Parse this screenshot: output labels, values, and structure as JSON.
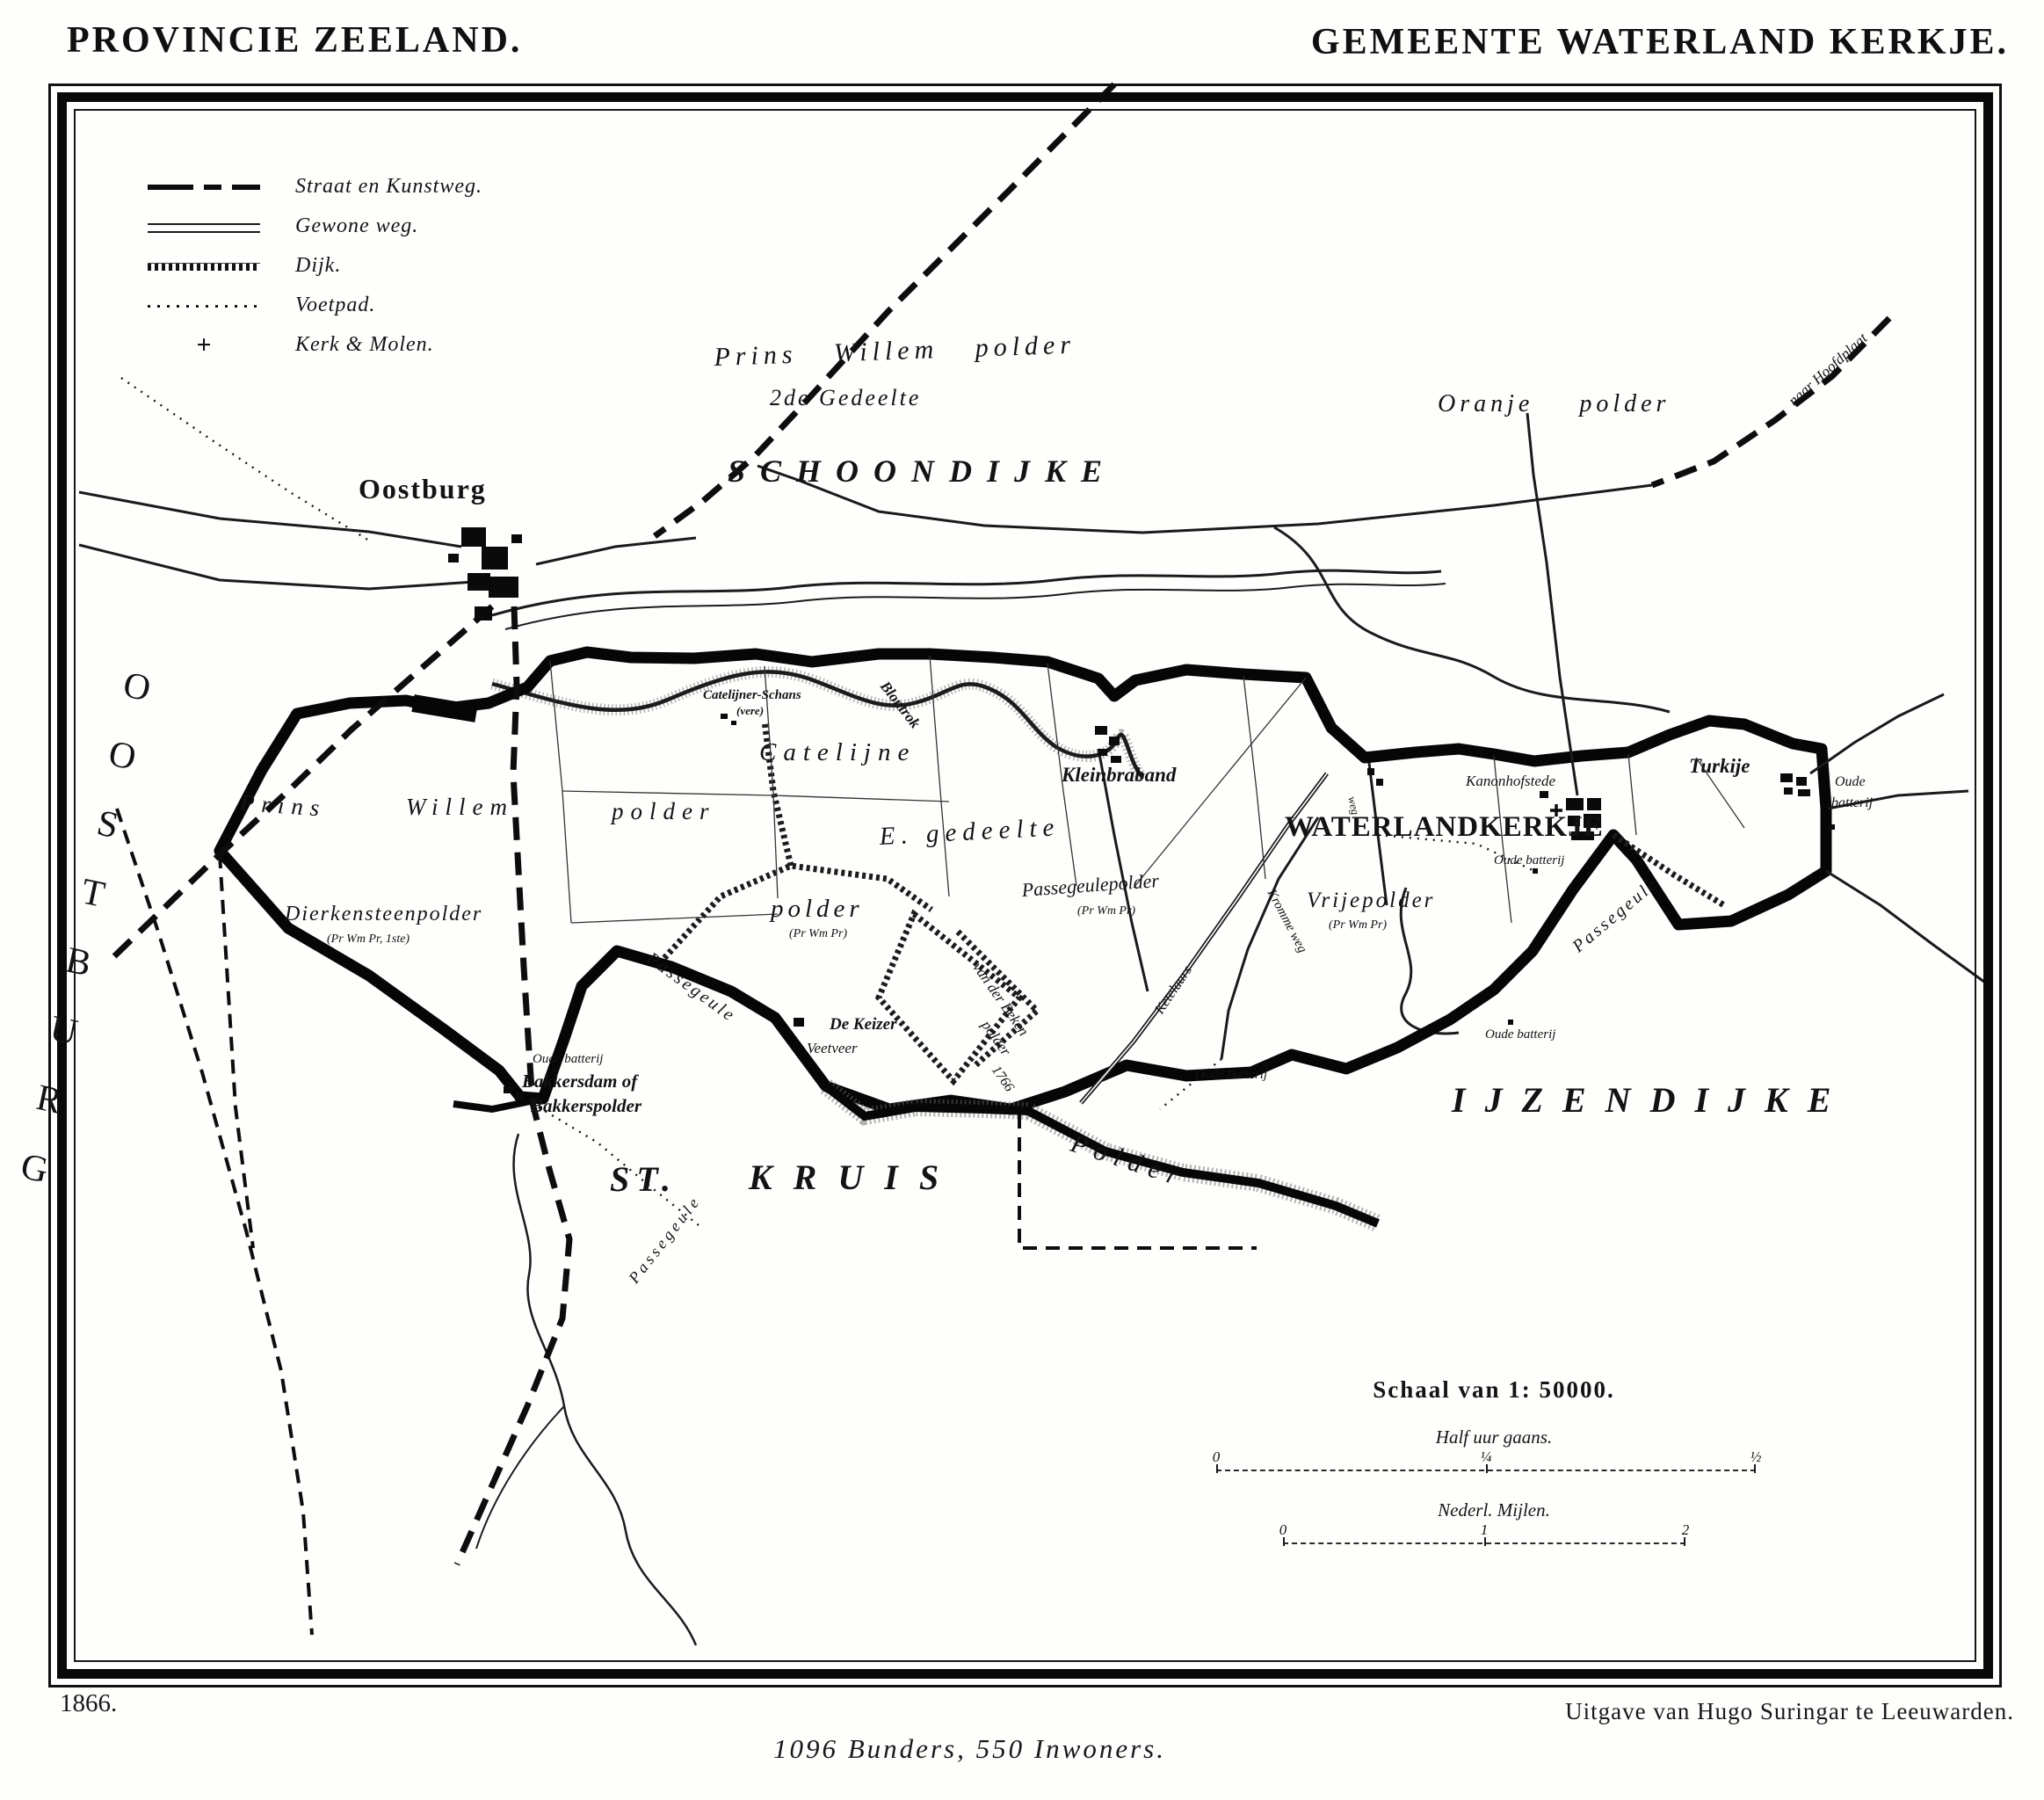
{
  "page": {
    "title_left": "PROVINCIE ZEELAND.",
    "title_right": "GEMEENTE WATERLAND KERKJE.",
    "year": "1866.",
    "publisher": "Uitgave van Hugo Suringar te Leeuwarden.",
    "stats": "1096 Bunders, 550 Inwoners."
  },
  "legend": {
    "items": [
      {
        "icon": "bold-dashed-line-icon",
        "label": "Straat en Kunstweg."
      },
      {
        "icon": "double-line-icon",
        "label": "Gewone weg."
      },
      {
        "icon": "hatched-line-icon",
        "label": "Dijk."
      },
      {
        "icon": "dotted-line-icon",
        "label": "Voetpad."
      },
      {
        "icon": "cross-windmill-icon",
        "label": "Kerk & Molen."
      }
    ],
    "kerk_glyph": "+"
  },
  "scale": {
    "title": "Schaal van 1: 50000.",
    "bar1_label": "Half uur gaans.",
    "bar1_ticks": [
      "0",
      "¼",
      "½"
    ],
    "bar2_label": "Nederl. Mijlen.",
    "bar2_ticks": [
      "0",
      "1",
      "2"
    ]
  },
  "labels": {
    "oostburg_region": "OOSTBURG",
    "oostburg_town": "Oostburg",
    "schoondijke": "SCHOONDIJKE",
    "prins_willem_polder": "Prins Willem polder",
    "tweede_gedeelte": "2de Gedeelte",
    "oranje_polder": "Oranje polder",
    "naar_hoofdplaat": "naar Hoofdplaat",
    "catelijner_schans": "Catelijner-Schans",
    "catelijner_schans_sub": "(vere)",
    "blontrok": "Blontrok",
    "catelijne": "Catelijne",
    "e_gedeelte": "E. gedeelte",
    "polder_word": "polder",
    "pr_wm_pr": "(Pr Wm Pr)",
    "kleinbraband": "Kleinbraband",
    "passegeulepolder": "Passegeulepolder",
    "waterlandkerkje": "WATERLANDKERKJE",
    "kanonhofstede": "Kanonhofstede",
    "oude_batterij": "Oude batterij",
    "oude_batterij_cap": "Oude Batterij",
    "oude_split_1": "Oude",
    "oude_split_2": "batterij",
    "turkije": "Turkije",
    "weg": "weg",
    "vrijepolder": "Vrijepolder",
    "ketelaars": "Ketelaars",
    "kromme_weg": "Kromme weg",
    "passegeule": "Passegeule",
    "ijzendijke": "IJZENDIJKE",
    "prins": "Prins",
    "willem": "Willem",
    "dierkensteenpolder": "Dierkensteenpolder",
    "dierkensteenpolder_sub": "(Pr Wm Pr, 1ste)",
    "de_keizer": "De Keizer",
    "veetveer": "Veetveer",
    "van_der_beken": "van der Beken",
    "beken_year": "1766",
    "bakkersdam": "Bakkersdam of",
    "bakkerspolder": "Bakkerspolder",
    "st": "ST.",
    "kruis": "KRUIS",
    "polder_south": "Polder"
  }
}
